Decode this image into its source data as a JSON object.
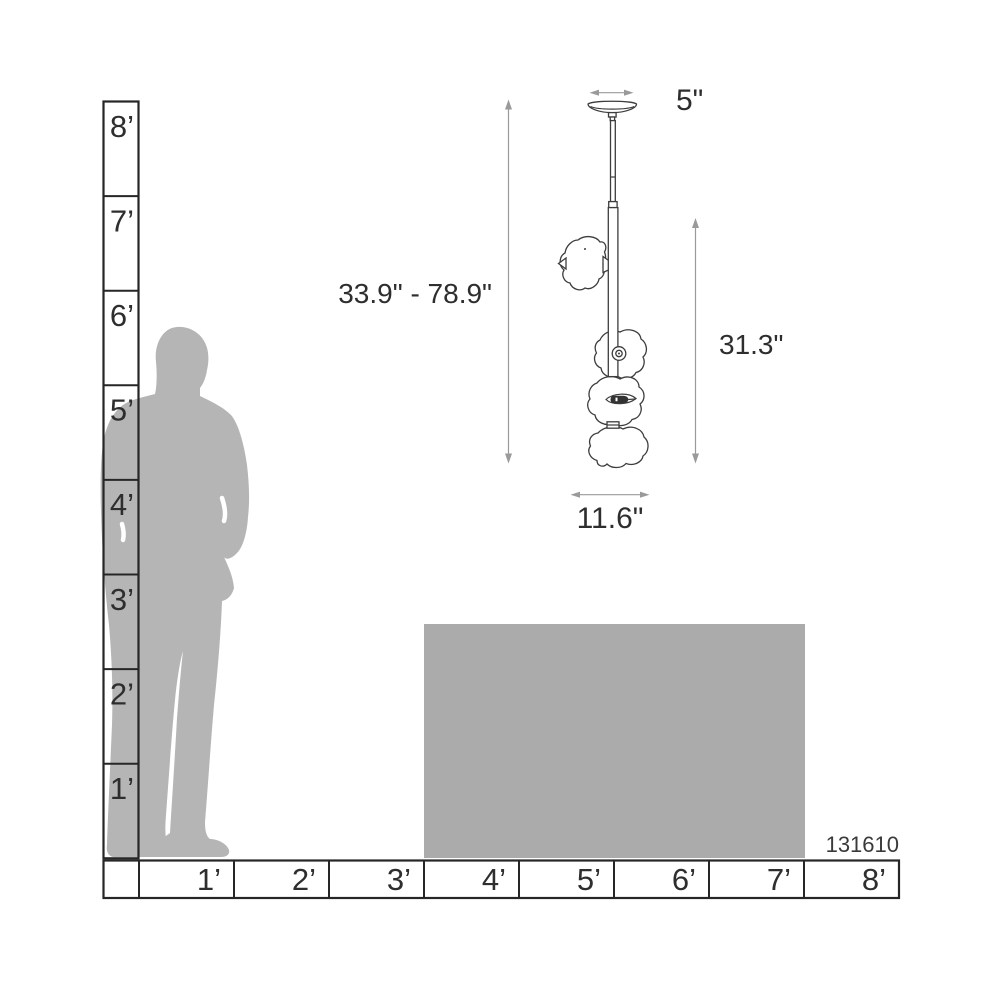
{
  "diagram": {
    "product_code": "131610",
    "dimension_labels": {
      "canopy_width": "5\"",
      "overall_height": "33.9\" - 78.9\"",
      "fixture_height": "31.3\"",
      "fixture_width": "11.6\""
    },
    "vertical_ruler": {
      "labels": [
        "8’",
        "7’",
        "6’",
        "5’",
        "4’",
        "3’",
        "2’",
        "1’"
      ]
    },
    "horizontal_ruler": {
      "labels": [
        "1’",
        "2’",
        "3’",
        "4’",
        "5’",
        "6’",
        "7’",
        "8’"
      ]
    },
    "colors": {
      "silhouette": "#b5b5b5",
      "table": "#ababab",
      "dimension_line": "#9a9a9a",
      "ruler_line": "#262626",
      "drawing_outline": "#3d3d3d",
      "text": "#2e2e2e"
    }
  }
}
